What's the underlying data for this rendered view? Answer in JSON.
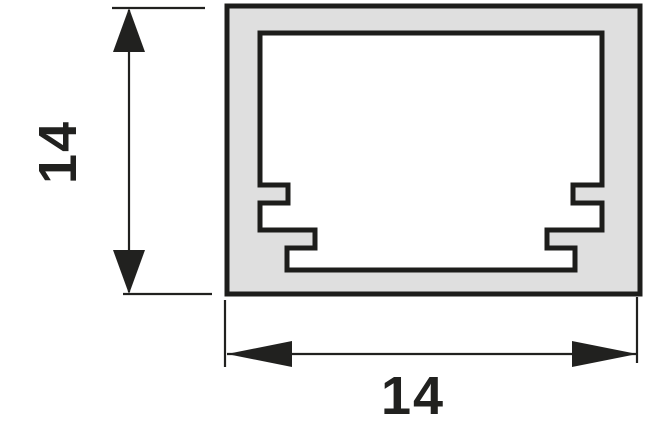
{
  "drawing": {
    "kind": "profile-cross-section-technical-drawing",
    "dimensions": {
      "height": {
        "value": "14"
      },
      "width": {
        "value": "14"
      }
    },
    "colors": {
      "background": "#ffffff",
      "profile_fill": "#dfdfdf",
      "outline": "#1d1d1b",
      "dimension": "#21211f"
    }
  }
}
